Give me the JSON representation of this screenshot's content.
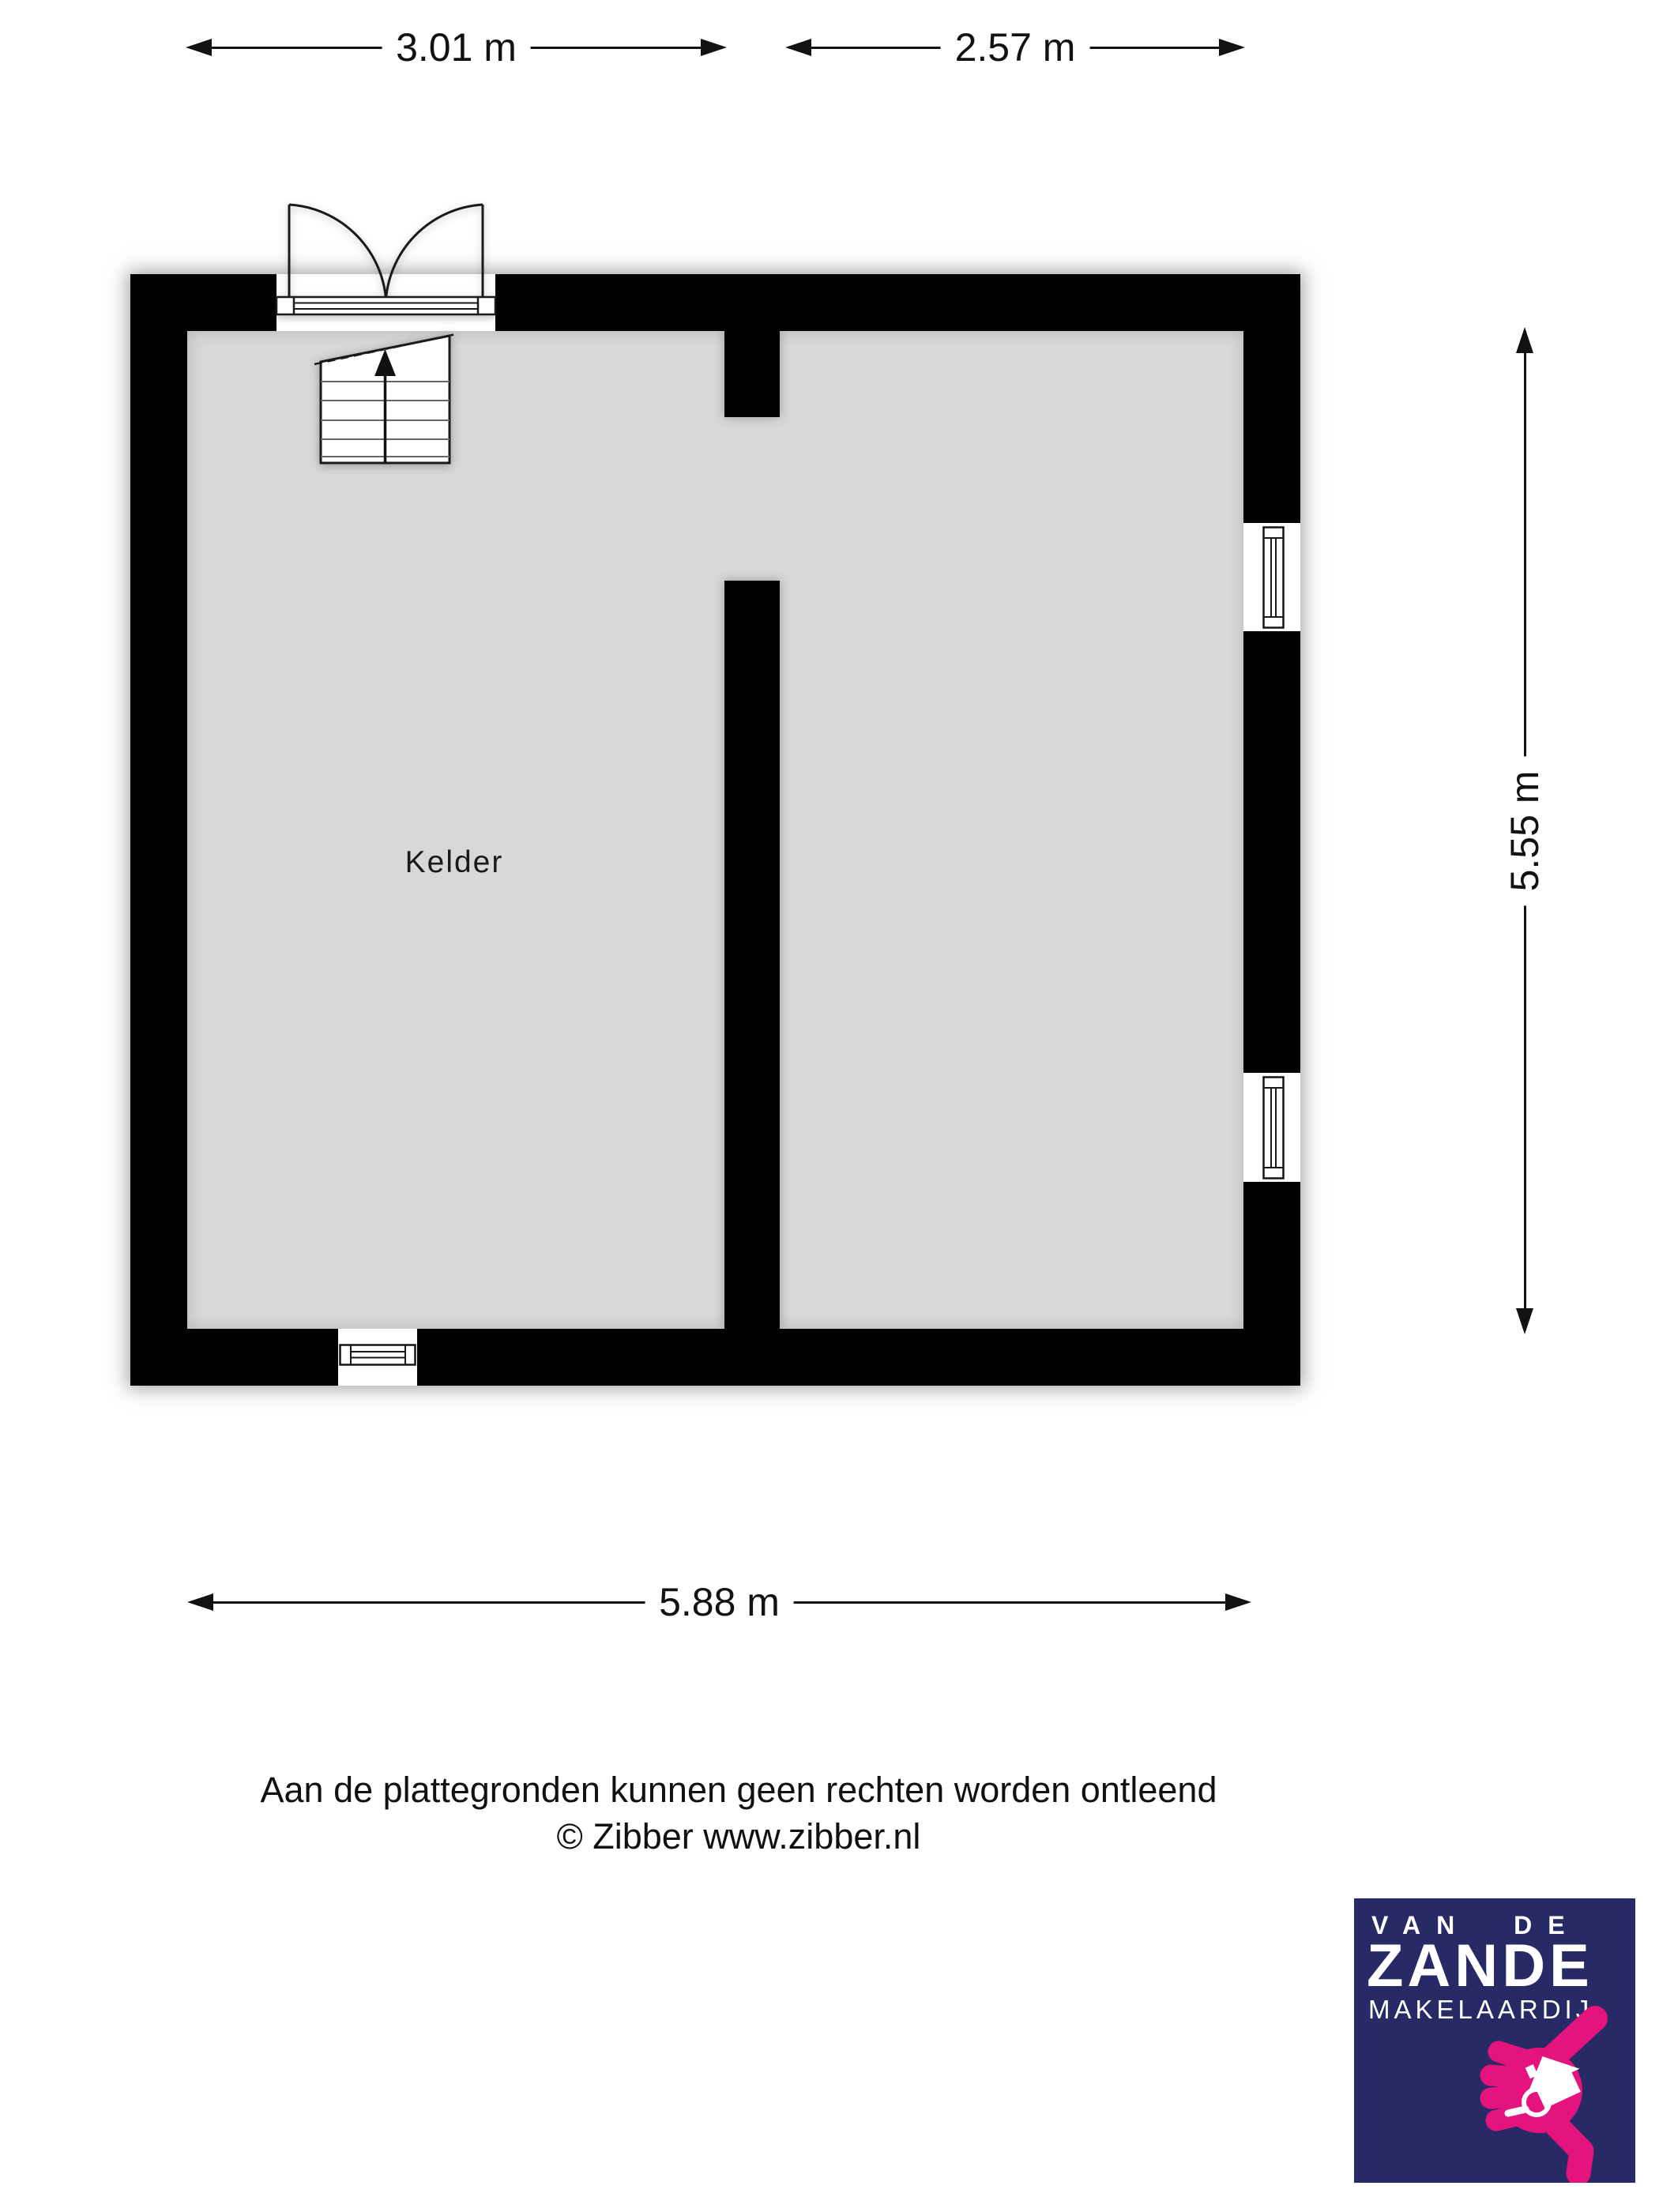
{
  "floor_plan": {
    "room_label": "Kelder",
    "dimensions": {
      "width_left": "3.01 m",
      "width_right": "2.57 m",
      "height_right": "5.55 m",
      "width_total": "5.88 m"
    },
    "features": [
      "double-door-top",
      "stairs-up-top-left",
      "window-right-upper",
      "window-right-lower",
      "window-bottom-left",
      "interior-dividing-wall"
    ],
    "colors": {
      "wall": "#000000",
      "floor": "#d8d8d8",
      "background": "#ffffff"
    }
  },
  "disclaimer": {
    "line1": "Aan de plattegronden kunnen geen rechten worden ontleend",
    "line2": "© Zibber www.zibber.nl"
  },
  "logo": {
    "line1": "VAN DE",
    "line2": "ZANDE",
    "line3": "MAKELAARDIJ",
    "colors": {
      "background": "#272a64",
      "accent": "#e5137d",
      "text": "#ffffff"
    }
  }
}
